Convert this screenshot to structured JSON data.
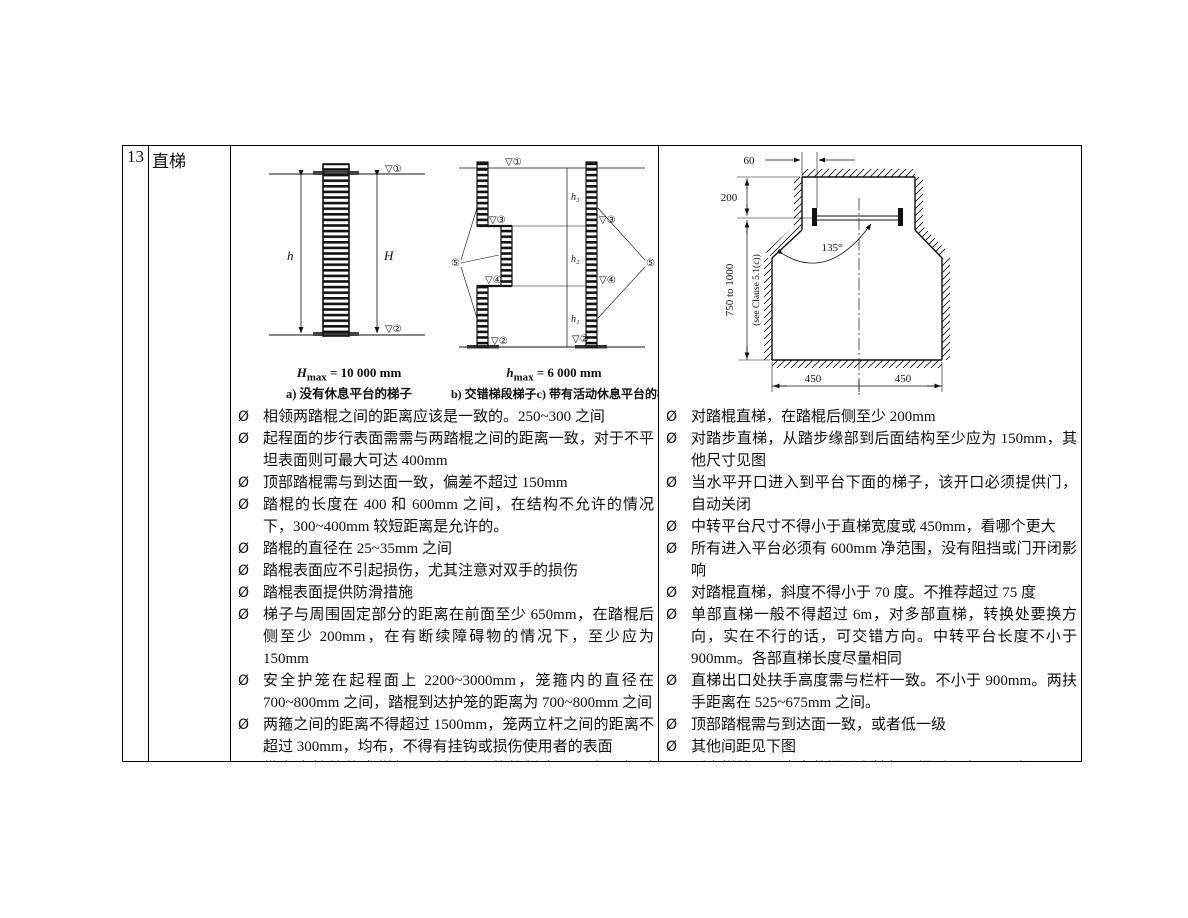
{
  "table": {
    "row_number": "13",
    "category": "直梯"
  },
  "bullet_marker": "Ø",
  "left_bullets": [
    "相领两踏棍之间的距离应该是一致的。250~300 之间",
    "起程面的步行表面需需与两踏棍之间的距离一致，对于不平坦表面则可最大可达 400mm",
    "顶部踏棍需与到达面一致，偏差不超过 150mm",
    "踏棍的长度在 400 和 600mm 之间，在结构不允许的情况下，300~400mm 较短距离是允许的。",
    "踏棍的直径在 25~35mm 之间",
    "踏棍表面应不引起损伤，尤其注意对双手的损伤",
    "踏棍表面提供防滑措施",
    "梯子与周围固定部分的距离在前面至少 650mm，在踏棍后侧至少 200mm，在有断续障碍物的情况下，至少应为 150mm",
    "安全护笼在起程面上 2200~3000mm，笼箍内的直径在 700~800mm 之间，踏棍到达护笼的距离为 700~800mm 之间",
    "两箍之间的距离不得超过 1500mm，笼两立杆之间的距离不超过 300mm，均布，不得有挂钩或损伤使用者的表面",
    "带安全护笼的直梯如果到起程面的护栏水平距离不超过 1.5m，则"
  ],
  "right_bullets": [
    "对踏棍直梯，在踏棍后侧至少 200mm",
    "对踏步直梯，从踏步缘部到后面结构至少应为 150mm，其他尺寸见图",
    "当水平开口进入到平台下面的梯子，该开口必须提供门，自动关闭",
    "中转平台尺寸不得小于直梯宽度或 450mm，看哪个更大",
    "所有进入平台必须有 600mm 净范围，没有阻挡或门开闭影响",
    "对踏棍直梯，斜度不得小于 70 度。不推荐超过 75 度",
    "单部直梯一般不得超过 6m，对多部直梯，转换处要换方向，实在不行的话，可交错方向。中转平台长度不小于 900mm。各部直梯长度尽量相同",
    "直梯出口处扶手高度需与栏杆一致。不小于 900mm。两扶手距离在 525~675mm 之间。",
    "顶部踏棍需与到达面一致，或者低一级",
    "其他间距见下图",
    "到直梯处入口应安装门后者挡杆，门后平台 1.5m 长，无需踢脚"
  ],
  "figures": {
    "a": {
      "formula_var": "H",
      "formula_sub": "max",
      "formula_rest": " = 10 000 mm",
      "caption": "a) 没有休息平台的梯子",
      "dim_left": "h",
      "dim_right": "H",
      "marker_top": "▽①",
      "marker_bottom": "▽②"
    },
    "bc": {
      "formula_var": "h",
      "formula_sub": "max",
      "formula_rest": " = 6 000 mm",
      "caption_b": "b) 交错梯段梯子",
      "caption_c": "c) 带有活动休息平台的梯子",
      "marker_top": "▽①",
      "marker_left_1": "▽③",
      "marker_left_2": "▽④",
      "marker_left_bottom": "▽②",
      "marker_right_1": "▽③",
      "marker_right_2": "▽④",
      "marker_right_bottom": "▽②",
      "callout_left": "⑤",
      "callout_right": "⑤",
      "seg_label_top": "h₃",
      "seg_label_mid": "h₂",
      "seg_label_bottom": "h₁"
    },
    "opening": {
      "dim_top": "60",
      "dim_upper": "200",
      "dim_vertical": "750 to 1000",
      "dim_vertical_note": "(see Clause 5.1(c))",
      "angle": "135°",
      "dim_bottom_left": "450",
      "dim_bottom_right": "450"
    }
  }
}
